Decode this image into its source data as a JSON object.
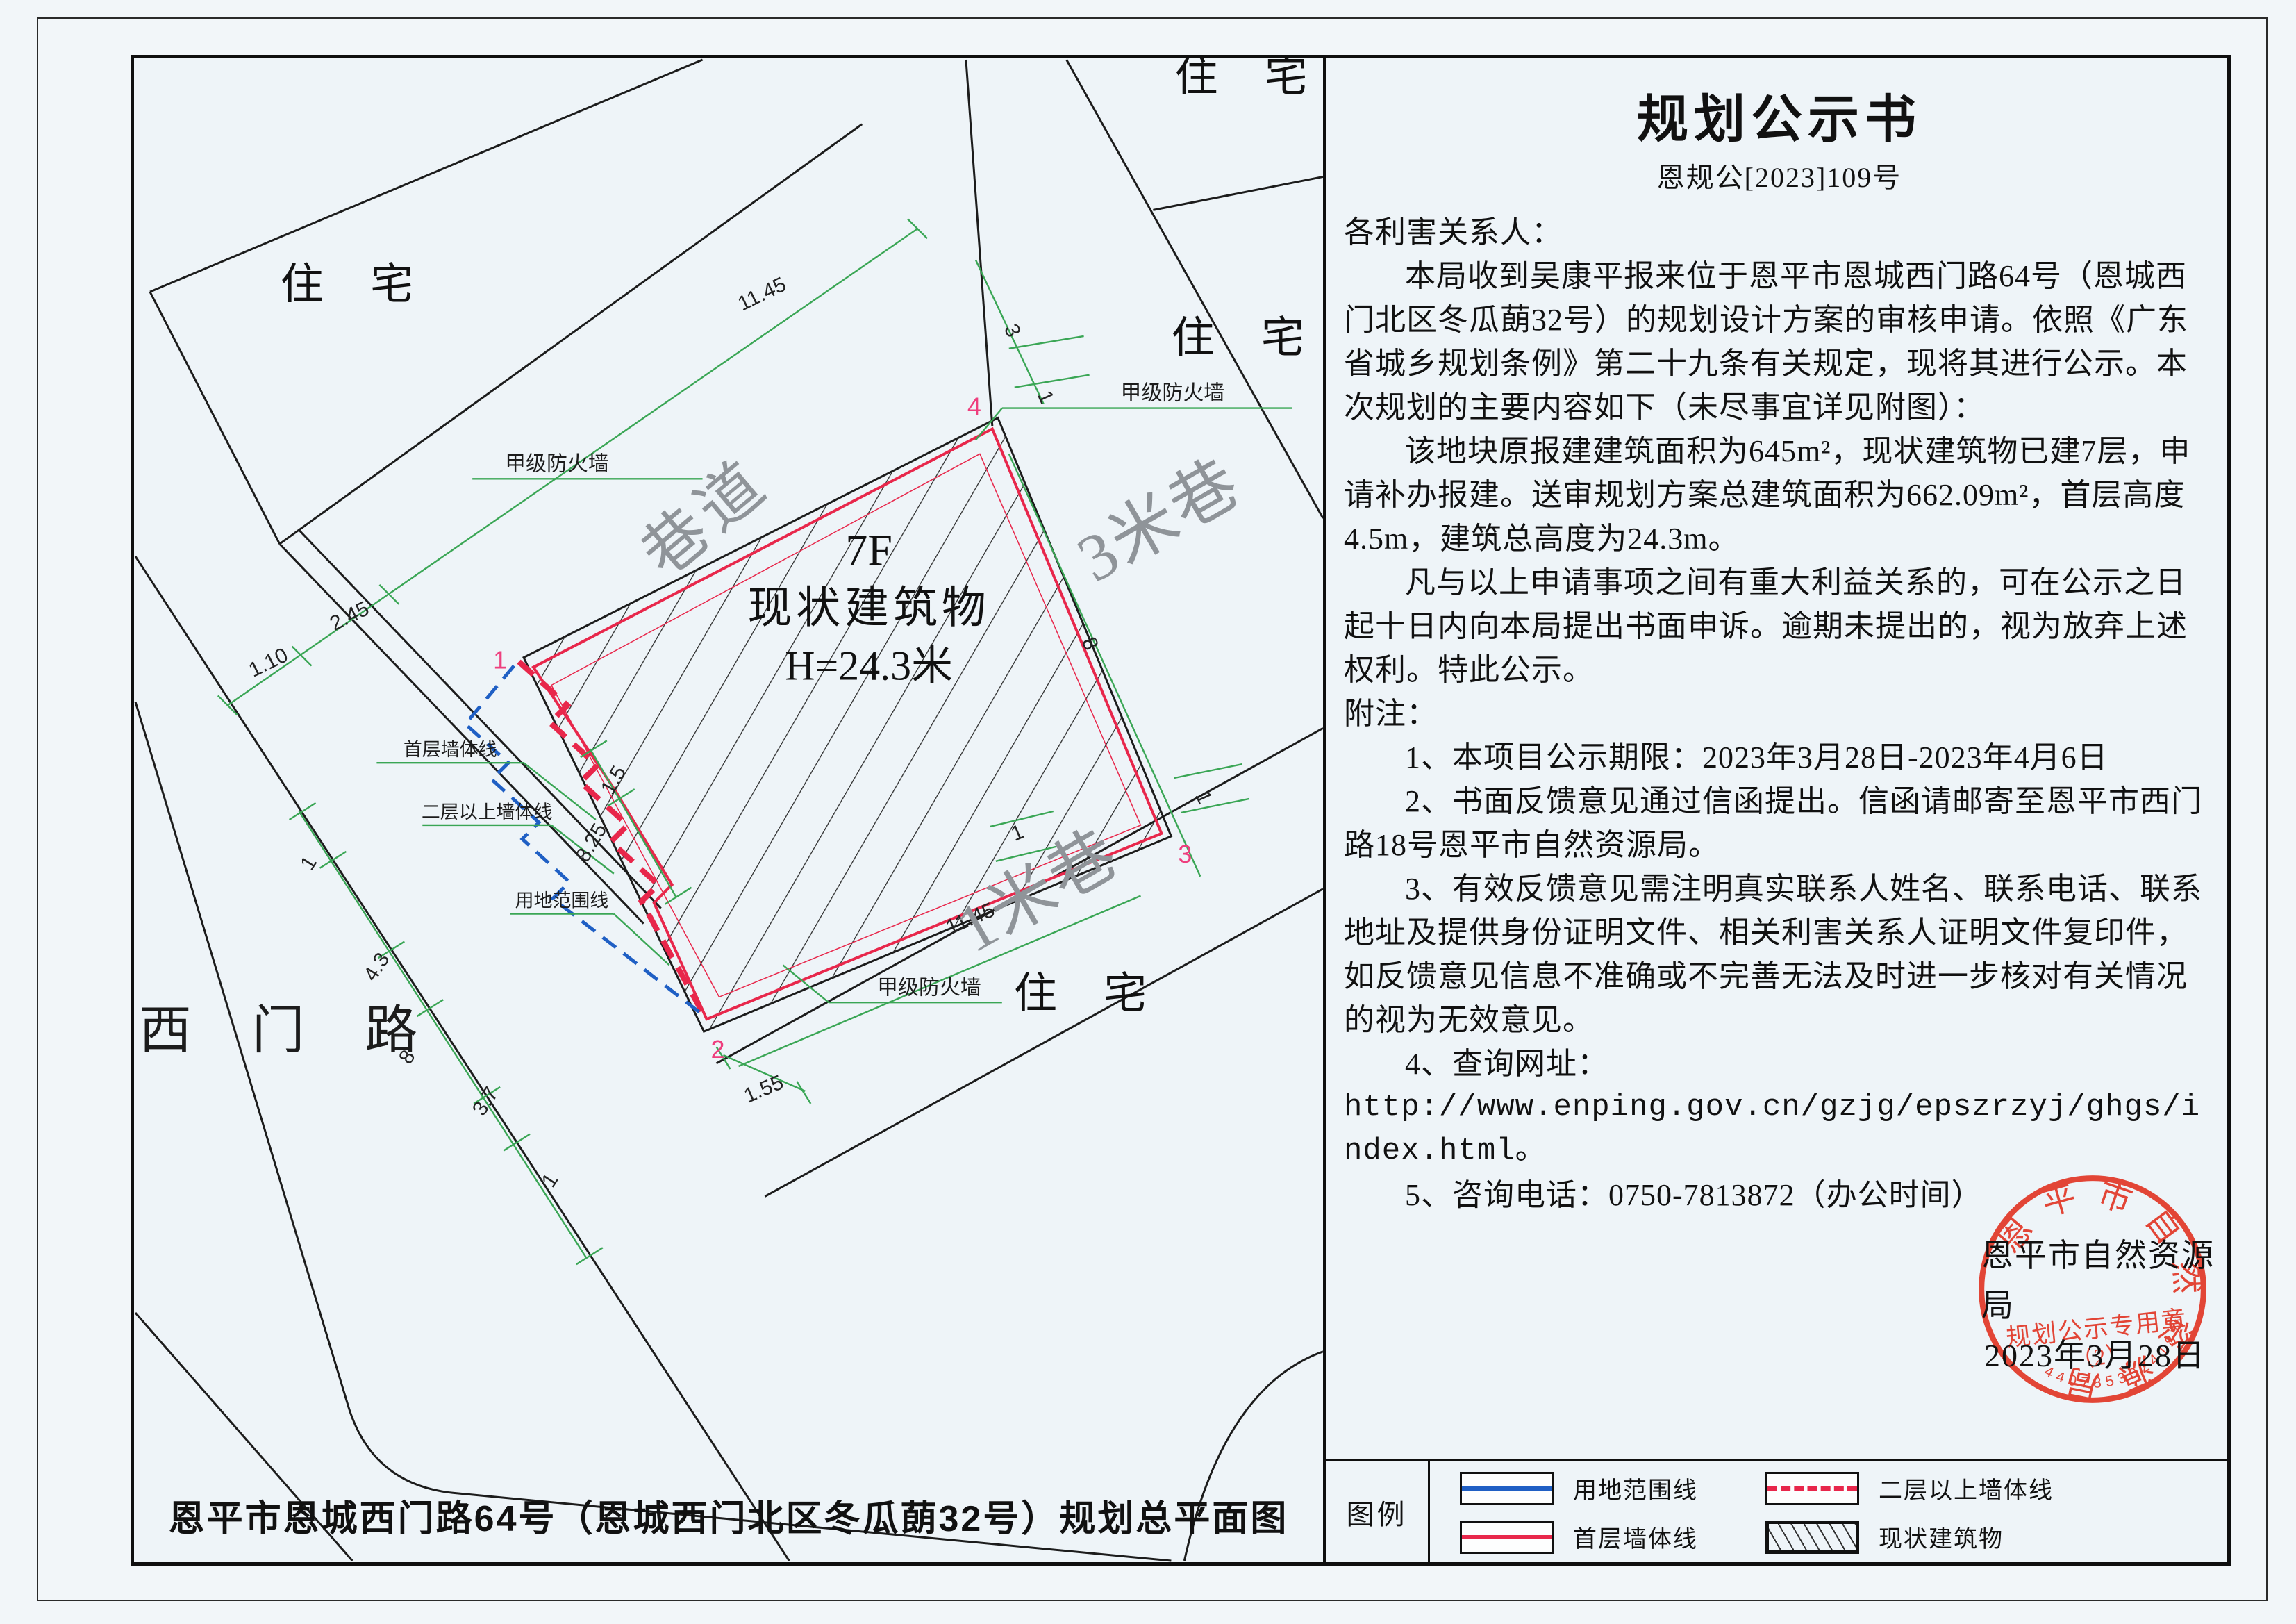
{
  "notice": {
    "title": "规划公示书",
    "doc_number": "恩规公[2023]109号",
    "paragraphs": [
      "各利害关系人：",
      "本局收到吴康平报来位于恩平市恩城西门路64号（恩城西门北区冬瓜蓢32号）的规划设计方案的审核申请。依照《广东省城乡规划条例》第二十九条有关规定，现将其进行公示。本次规划的主要内容如下（未尽事宜详见附图）：",
      "该地块原报建建筑面积为645m²，现状建筑物已建7层，申请补办报建。送审规划方案总建筑面积为662.09m²，首层高度4.5m，建筑总高度为24.3m。",
      "凡与以上申请事项之间有重大利益关系的，可在公示之日起十日内向本局提出书面申诉。逾期未提出的，视为放弃上述权利。特此公示。",
      "附注：",
      "1、本项目公示期限：2023年3月28日-2023年4月6日",
      "2、书面反馈意见通过信函提出。信函请邮寄至恩平市西门路18号恩平市自然资源局。",
      "3、有效反馈意见需注明真实联系人姓名、联系电话、联系地址及提供身份证明文件、相关利害关系人证明文件复印件，如反馈意见信息不准确或不完善无法及时进一步核对有关情况的视为无效意见。",
      "4、查询网址：",
      "http://www.enping.gov.cn/gzjg/epszrzyj/ghgs/index.html。",
      "5、咨询电话：0750-7813872（办公时间）"
    ],
    "signature_org": "恩平市自然资源局",
    "signature_date": "2023年3月28日"
  },
  "stamp": {
    "ring_text": "恩平市自然资源局",
    "center_line": "规划公示专用章",
    "center_sub": "（2）",
    "serial": "4407853024187",
    "color": "#e23726"
  },
  "plan": {
    "caption": "恩平市恩城西门路64号（恩城西门北区冬瓜蓢32号）规划总平面图",
    "building_floors": "7F",
    "building_name": "现状建筑物",
    "building_height": "H=24.3米",
    "residential": "住 宅",
    "lane_nw": "巷道",
    "lane_east": "3米巷",
    "lane_south": "1米巷",
    "road_west": "西 门 路",
    "firewall": "甲级防火墙",
    "label_first_floor_wall": "首层墙体线",
    "label_upper_wall": "二层以上墙体线",
    "label_site_boundary": "用地范围线",
    "corner_1": "1",
    "corner_2": "2",
    "corner_3": "3",
    "corner_4": "4",
    "dims": [
      "11.45",
      "2.45",
      "1.10",
      "3",
      "1",
      "8",
      "1",
      "11.45",
      "1",
      "1.55",
      "1.5",
      "8.25",
      "1",
      "4.3",
      "8",
      "3.7",
      "1"
    ]
  },
  "legend": {
    "label": "图例",
    "items": [
      {
        "name": "用地范围线"
      },
      {
        "name": "二层以上墙体线"
      },
      {
        "name": "首层墙体线"
      },
      {
        "name": "现状建筑物"
      }
    ]
  },
  "colors": {
    "wall_red": "#e8274b",
    "boundary_blue": "#1f5fc4",
    "dim_green": "#3aa655",
    "stamp_red": "#e23726",
    "label_gray": "#8f9499"
  }
}
